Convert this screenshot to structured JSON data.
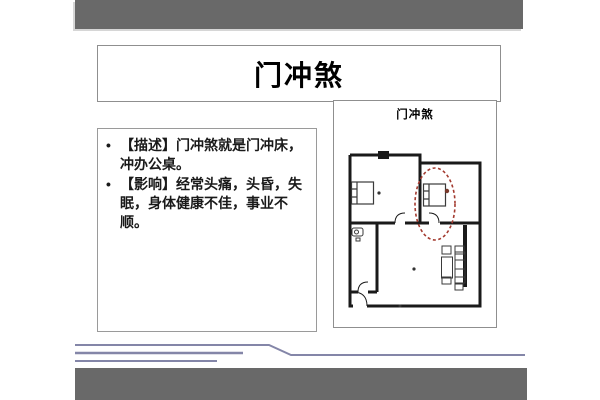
{
  "slide": {
    "title": "门冲煞",
    "content": {
      "bullet_char": "•",
      "bullets": [
        "【描述】门冲煞就是门冲床，冲办公桌。",
        "【影响】经常头痛，头昏，失眠，身体健康不佳，事业不顺。"
      ]
    },
    "diagram": {
      "label": "门冲煞"
    },
    "colors": {
      "bar_gray": "#696969",
      "accent_line_purple": "#8486a8",
      "highlight_red": "#a33a2f",
      "wall_black": "#1a1a1a",
      "border_gray": "#8f8f8f"
    }
  }
}
